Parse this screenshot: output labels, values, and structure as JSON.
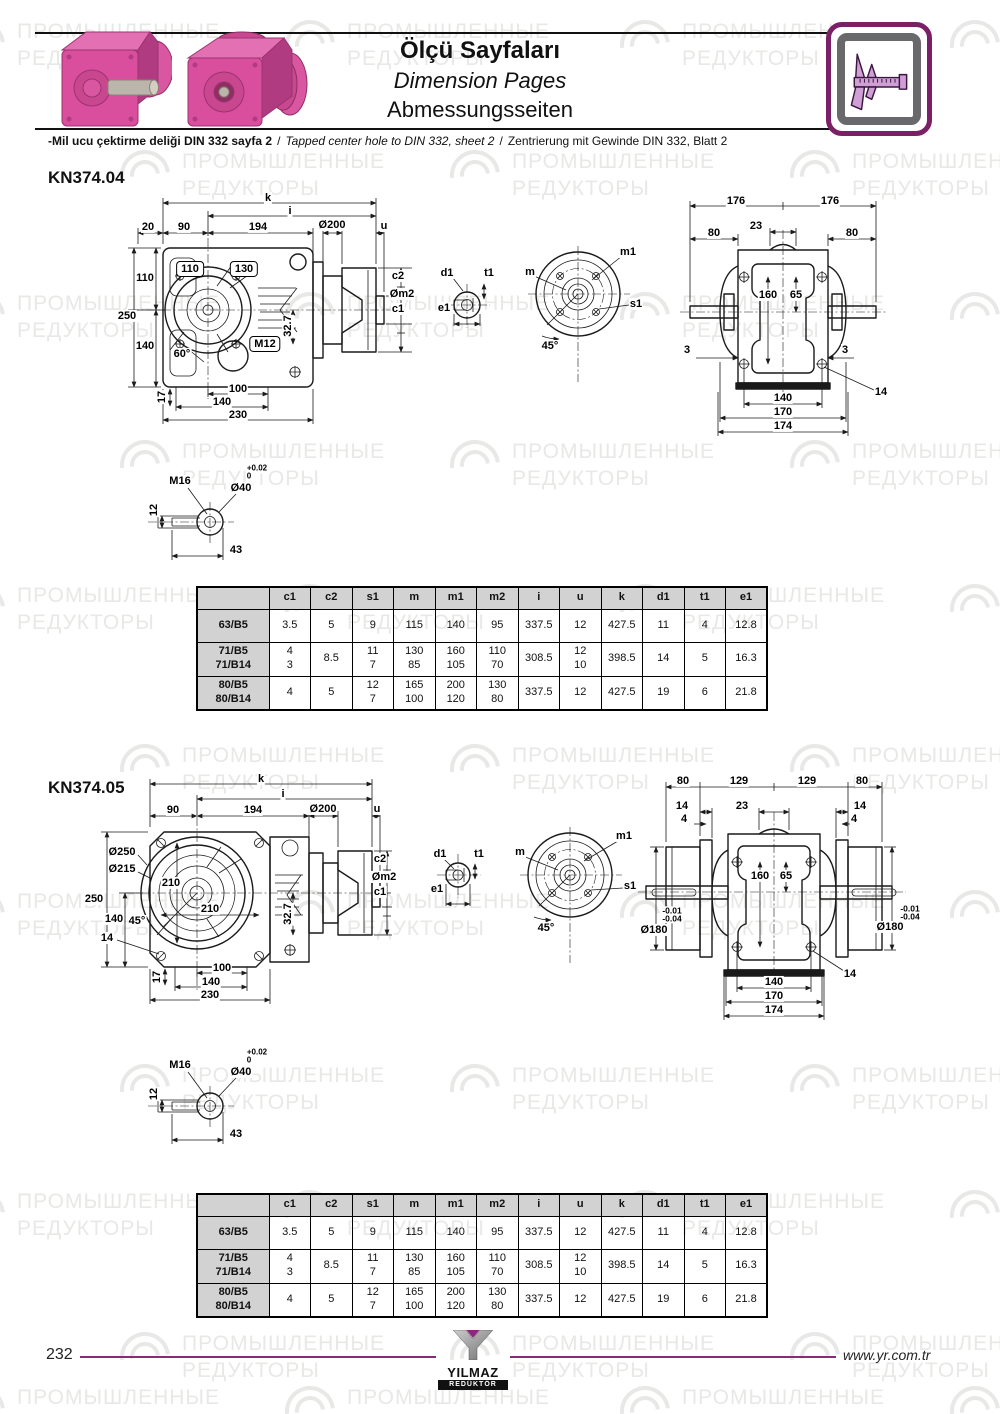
{
  "header": {
    "title_tr": "Ölçü Sayfaları",
    "title_en": "Dimension Pages",
    "title_de": "Abmessungsseiten",
    "note_tr": "-Mil ucu çektirme deliği DIN 332 sayfa 2",
    "note_sep1": "/",
    "note_en": "Tapped center hole to DIN 332, sheet 2",
    "note_sep2": "/",
    "note_de": "Zentrierung mit Gewinde DIN 332, Blatt 2"
  },
  "watermark": {
    "line1": "ПРОМЫШЛЕННЫЕ",
    "line2": "РЕДУКТОРЫ"
  },
  "sections": [
    {
      "label": "KN374.04"
    },
    {
      "label": "KN374.05"
    }
  ],
  "table": {
    "headers": [
      "c1",
      "c2",
      "s1",
      "m",
      "m1",
      "m2",
      "i",
      "u",
      "k",
      "d1",
      "t1",
      "e1"
    ],
    "rows": [
      {
        "label": "63/B5",
        "values": [
          "3.5",
          "5",
          "9",
          "115",
          "140",
          "95",
          "337.5",
          "12",
          "427.5",
          "11",
          "4",
          "12.8"
        ]
      },
      {
        "label": "71/B5\n71/B14",
        "values": [
          "4\n3",
          "8.5",
          "11\n7",
          "130\n85",
          "160\n105",
          "110\n70",
          "308.5",
          "12\n10",
          "398.5",
          "14",
          "5",
          "16.3"
        ]
      },
      {
        "label": "80/B5\n80/B14",
        "values": [
          "4",
          "5",
          "12\n7",
          "165\n100",
          "200\n120",
          "130\n80",
          "337.5",
          "12",
          "427.5",
          "19",
          "6",
          "21.8"
        ]
      }
    ]
  },
  "drawings": {
    "d1": {
      "labels": [
        {
          "t": "k",
          "x": 150,
          "y": 6
        },
        {
          "t": "i",
          "x": 172,
          "y": 19
        },
        {
          "t": "20",
          "x": 30,
          "y": 35
        },
        {
          "t": "90",
          "x": 66,
          "y": 35
        },
        {
          "t": "194",
          "x": 140,
          "y": 35
        },
        {
          "t": "Ø200",
          "x": 214,
          "y": 33
        },
        {
          "t": "u",
          "x": 266,
          "y": 34
        },
        {
          "t": "110",
          "x": 72,
          "y": 77,
          "b": 1
        },
        {
          "t": "130",
          "x": 126,
          "y": 77,
          "b": 1
        },
        {
          "t": "110",
          "x": 27,
          "y": 86
        },
        {
          "t": "250",
          "x": 9,
          "y": 124
        },
        {
          "t": "140",
          "x": 27,
          "y": 154
        },
        {
          "t": "60°",
          "x": 64,
          "y": 162
        },
        {
          "t": "M12",
          "x": 147,
          "y": 152,
          "b": 1
        },
        {
          "t": "32.7",
          "x": 170,
          "y": 134,
          "r": 1
        },
        {
          "t": "c2",
          "x": 280,
          "y": 84
        },
        {
          "t": "Øm2",
          "x": 284,
          "y": 102
        },
        {
          "t": "c1",
          "x": 280,
          "y": 117
        },
        {
          "t": "17",
          "x": 44,
          "y": 205,
          "r": 1
        },
        {
          "t": "100",
          "x": 120,
          "y": 197
        },
        {
          "t": "140",
          "x": 104,
          "y": 210
        },
        {
          "t": "230",
          "x": 120,
          "y": 223
        }
      ]
    },
    "d2": {
      "labels": [
        {
          "t": "d1",
          "x": 15,
          "y": 31
        },
        {
          "t": "t1",
          "x": 57,
          "y": 31
        },
        {
          "t": "e1",
          "x": 12,
          "y": 66
        },
        {
          "t": "m",
          "x": 98,
          "y": 30
        },
        {
          "t": "m1",
          "x": 196,
          "y": 10
        },
        {
          "t": "s1",
          "x": 204,
          "y": 62
        },
        {
          "t": "45°",
          "x": 118,
          "y": 104
        }
      ]
    },
    "d3": {
      "labels": [
        {
          "t": "176",
          "x": 58,
          "y": 9
        },
        {
          "t": "176",
          "x": 152,
          "y": 9
        },
        {
          "t": "23",
          "x": 78,
          "y": 34
        },
        {
          "t": "80",
          "x": 36,
          "y": 41
        },
        {
          "t": "80",
          "x": 174,
          "y": 41
        },
        {
          "t": "160",
          "x": 90,
          "y": 103
        },
        {
          "t": "65",
          "x": 118,
          "y": 103
        },
        {
          "t": "3",
          "x": 9,
          "y": 158
        },
        {
          "t": "3",
          "x": 167,
          "y": 158
        },
        {
          "t": "14",
          "x": 203,
          "y": 200
        },
        {
          "t": "140",
          "x": 105,
          "y": 206
        },
        {
          "t": "170",
          "x": 105,
          "y": 220
        },
        {
          "t": "174",
          "x": 105,
          "y": 234
        }
      ]
    },
    "d4": {
      "labels": [
        {
          "t": "M16",
          "x": 52,
          "y": 23
        },
        {
          "t": "Ø40",
          "x": 113,
          "y": 30
        },
        {
          "t": "+0.02",
          "x": 129,
          "y": 11,
          "fs": 8
        },
        {
          "t": "0",
          "x": 121,
          "y": 19,
          "fs": 8
        },
        {
          "t": "12",
          "x": 26,
          "y": 52,
          "r": 1
        },
        {
          "t": "43",
          "x": 108,
          "y": 92
        }
      ]
    },
    "d5": {
      "labels": [
        {
          "t": "k",
          "x": 176,
          "y": 4
        },
        {
          "t": "i",
          "x": 198,
          "y": 19
        },
        {
          "t": "90",
          "x": 88,
          "y": 35
        },
        {
          "t": "194",
          "x": 168,
          "y": 35
        },
        {
          "t": "Ø200",
          "x": 238,
          "y": 34
        },
        {
          "t": "u",
          "x": 292,
          "y": 34
        },
        {
          "t": "Ø250",
          "x": 37,
          "y": 77
        },
        {
          "t": "Ø215",
          "x": 37,
          "y": 94
        },
        {
          "t": "210",
          "x": 86,
          "y": 108
        },
        {
          "t": "210",
          "x": 125,
          "y": 134
        },
        {
          "t": "250",
          "x": 9,
          "y": 124
        },
        {
          "t": "140",
          "x": 29,
          "y": 144
        },
        {
          "t": "45°",
          "x": 52,
          "y": 146
        },
        {
          "t": "14",
          "x": 22,
          "y": 163
        },
        {
          "t": "32.7",
          "x": 203,
          "y": 139,
          "r": 1
        },
        {
          "t": "c2",
          "x": 295,
          "y": 84
        },
        {
          "t": "Øm2",
          "x": 299,
          "y": 102
        },
        {
          "t": "c1",
          "x": 295,
          "y": 117
        },
        {
          "t": "17",
          "x": 72,
          "y": 202,
          "r": 1
        },
        {
          "t": "100",
          "x": 137,
          "y": 193
        },
        {
          "t": "140",
          "x": 126,
          "y": 207
        },
        {
          "t": "230",
          "x": 125,
          "y": 220
        }
      ]
    },
    "d6": {
      "labels": [
        {
          "t": "d1",
          "x": 15,
          "y": 32
        },
        {
          "t": "t1",
          "x": 54,
          "y": 32
        },
        {
          "t": "e1",
          "x": 12,
          "y": 67
        },
        {
          "t": "m",
          "x": 95,
          "y": 30
        },
        {
          "t": "m1",
          "x": 199,
          "y": 14
        },
        {
          "t": "s1",
          "x": 205,
          "y": 64
        },
        {
          "t": "45°",
          "x": 121,
          "y": 106
        }
      ]
    },
    "d7": {
      "labels": [
        {
          "t": "80",
          "x": 45,
          "y": 9
        },
        {
          "t": "129",
          "x": 101,
          "y": 9
        },
        {
          "t": "129",
          "x": 169,
          "y": 9
        },
        {
          "t": "80",
          "x": 224,
          "y": 9
        },
        {
          "t": "14",
          "x": 44,
          "y": 34
        },
        {
          "t": "23",
          "x": 104,
          "y": 34
        },
        {
          "t": "14",
          "x": 222,
          "y": 34
        },
        {
          "t": "4",
          "x": 46,
          "y": 47
        },
        {
          "t": "4",
          "x": 216,
          "y": 47
        },
        {
          "t": "160",
          "x": 122,
          "y": 104
        },
        {
          "t": "65",
          "x": 148,
          "y": 104
        },
        {
          "t": "-0.01",
          "x": 34,
          "y": 139,
          "fs": 8.5
        },
        {
          "t": "-0.04",
          "x": 34,
          "y": 147,
          "fs": 8.5
        },
        {
          "t": "Ø180",
          "x": 16,
          "y": 158
        },
        {
          "t": "-0.01",
          "x": 272,
          "y": 137,
          "fs": 8.5
        },
        {
          "t": "-0.04",
          "x": 272,
          "y": 145,
          "fs": 8.5
        },
        {
          "t": "Ø180",
          "x": 252,
          "y": 155
        },
        {
          "t": "14",
          "x": 212,
          "y": 202
        },
        {
          "t": "140",
          "x": 136,
          "y": 210
        },
        {
          "t": "170",
          "x": 136,
          "y": 224
        },
        {
          "t": "174",
          "x": 136,
          "y": 238
        }
      ]
    },
    "d8": {
      "labels": [
        {
          "t": "M16",
          "x": 52,
          "y": 23
        },
        {
          "t": "Ø40",
          "x": 113,
          "y": 30
        },
        {
          "t": "+0.02",
          "x": 129,
          "y": 11,
          "fs": 8
        },
        {
          "t": "0",
          "x": 121,
          "y": 19,
          "fs": 8
        },
        {
          "t": "12",
          "x": 26,
          "y": 52,
          "r": 1
        },
        {
          "t": "43",
          "x": 108,
          "y": 92
        }
      ]
    }
  },
  "footer": {
    "page_number": "232",
    "logo_line1": "YILMAZ",
    "logo_line2": "REDÜKTÖR",
    "website": "www.yr.com.tr"
  },
  "colors": {
    "accent_purple": "#8a2a7d",
    "icon_border_purple": "#7b2066",
    "gearbox_pink": "#d94f9e",
    "table_header_bg": "#d2d2d2",
    "watermark_gray": "#e8e8e6"
  }
}
